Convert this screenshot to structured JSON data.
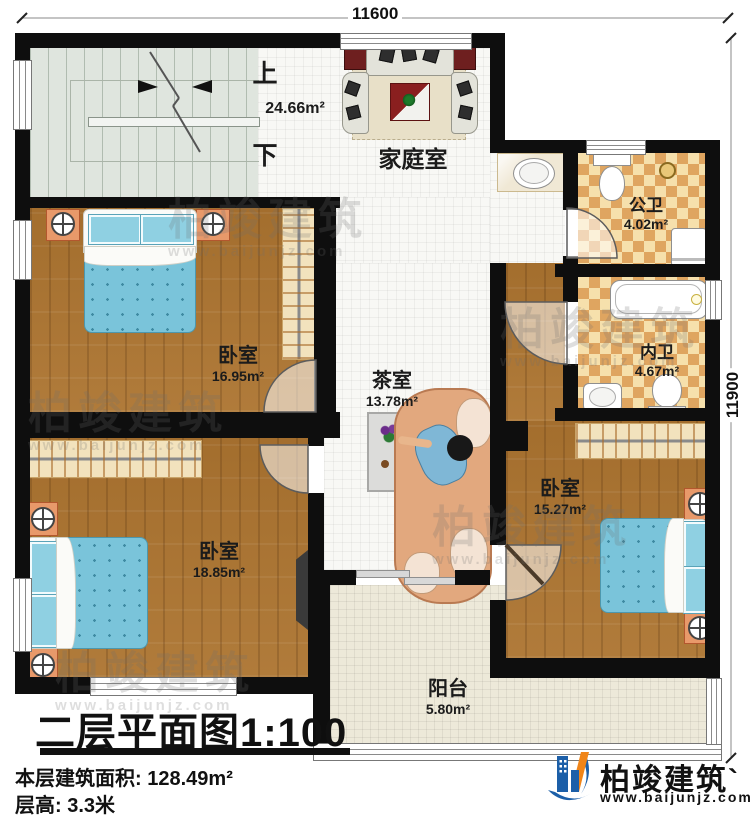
{
  "dimensions": {
    "top": "11600",
    "right": "11900"
  },
  "stairs": {
    "up_label": "上",
    "down_label": "下"
  },
  "rooms": {
    "family_room": {
      "name": "家庭室",
      "area": "24.66m²"
    },
    "public_bathroom": {
      "name": "公卫",
      "area": "4.02m²"
    },
    "private_bathroom": {
      "name": "内卫",
      "area": "4.67m²"
    },
    "bedroom_top_left": {
      "name": "卧室",
      "area": "16.95m²"
    },
    "tea_room": {
      "name": "茶室",
      "area": "13.78m²"
    },
    "bedroom_bottom_left": {
      "name": "卧室",
      "area": "18.85m²"
    },
    "bedroom_right": {
      "name": "卧室",
      "area": "15.27m²"
    },
    "balcony": {
      "name": "阳台",
      "area": "5.80m²"
    }
  },
  "title_block": {
    "plan_title": "二层平面图",
    "plan_scale": "1:100",
    "floor_area_label": "本层建筑面积:",
    "floor_area_value": "128.49m²",
    "floor_height_label": "层高:",
    "floor_height_value": "3.3米"
  },
  "branding": {
    "logo_text": "柏竣建筑",
    "website": "www.baijunjz.com"
  },
  "watermark": {
    "text": "柏竣建筑",
    "website": "www.baijunjz.com"
  },
  "colors": {
    "wall": "#0e0e0e",
    "wood_floor": "#ac7430",
    "checker_dark": "#dfa560",
    "checker_light": "#f6e0ac",
    "bed_blue": "#7ac4da",
    "logo_blue": "#1c5fa8",
    "logo_orange": "#f08519"
  }
}
